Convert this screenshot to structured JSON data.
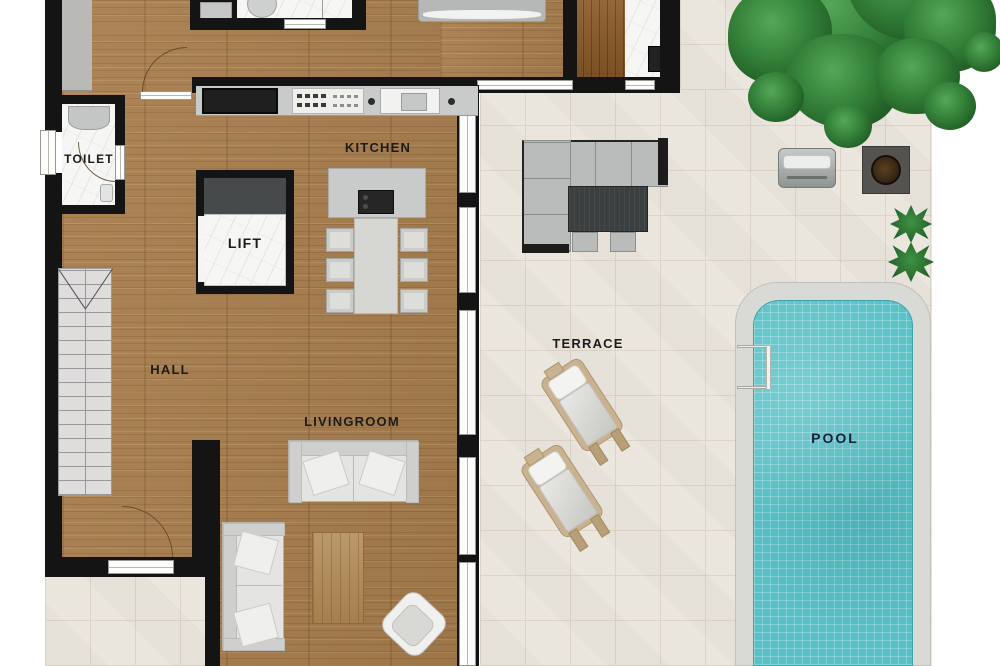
{
  "floorplan": {
    "labels": {
      "toilet": "TOILET",
      "kitchen": "KITCHEN",
      "sauna": "SAUNA",
      "lift": "LIFT",
      "hall": "HALL",
      "livingroom": "LIVINGROOM",
      "terrace": "TERRACE",
      "pool": "POOL"
    },
    "colors": {
      "wood-floor": "#a87e4e",
      "tile": "#eae5dd",
      "tile-line": "#dcd4c8",
      "wall": "#141414",
      "marble": "#f6f6f4",
      "sauna-wood": "#8a5a28",
      "pool-water": "#58c1c7",
      "pool-deck": "#d9d9d5",
      "tree-green": "#2e7a33",
      "furniture-gray": "#b9bcbb",
      "label-text": "#1c1c1a",
      "pool-label-text": "#15233f"
    }
  }
}
